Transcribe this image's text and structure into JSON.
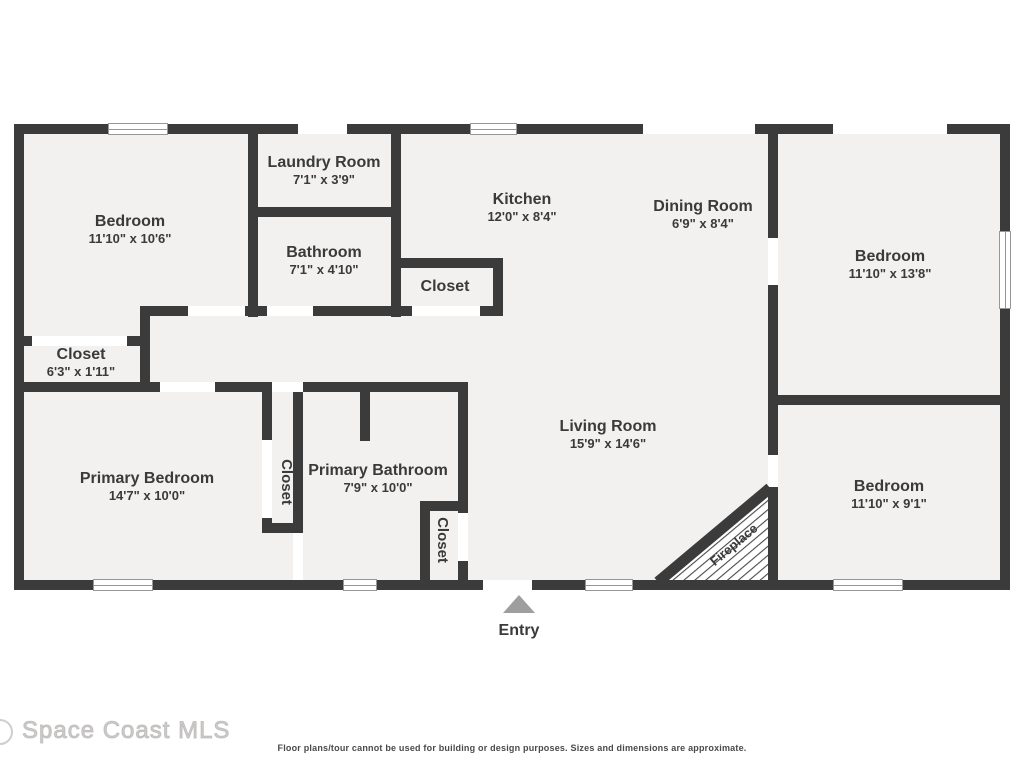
{
  "colors": {
    "wall": "#3b3b3b",
    "floor": "#f2f1f0",
    "window_line": "#979797",
    "entry_arrow": "#9e9e9e",
    "text": "#3a3a3a",
    "watermark": "#c1bfbd",
    "disclaimer": "#4a4a4a"
  },
  "watermark": "Space Coast MLS",
  "disclaimer": "Floor plans/tour cannot be used for building or design purposes. Sizes and dimensions are approximate.",
  "entry_label": "Entry",
  "rooms": [
    {
      "id": "bedroom-top-left",
      "name": "Bedroom",
      "dims": "11'10\" x 10'6\""
    },
    {
      "id": "laundry-room",
      "name": "Laundry Room",
      "dims": "7'1\" x 3'9\""
    },
    {
      "id": "bathroom",
      "name": "Bathroom",
      "dims": "7'1\" x 4'10\""
    },
    {
      "id": "kitchen",
      "name": "Kitchen",
      "dims": "12'0\" x 8'4\""
    },
    {
      "id": "dining-room",
      "name": "Dining Room",
      "dims": "6'9\" x 8'4\""
    },
    {
      "id": "bedroom-top-right",
      "name": "Bedroom",
      "dims": "11'10\" x 13'8\""
    },
    {
      "id": "closet-kitchen",
      "name": "Closet"
    },
    {
      "id": "closet-hall",
      "name": "Closet",
      "dims": "6'3\" x 1'11\""
    },
    {
      "id": "primary-bedroom",
      "name": "Primary Bedroom",
      "dims": "14'7\" x 10'0\""
    },
    {
      "id": "closet-primary",
      "name": "Closet"
    },
    {
      "id": "primary-bathroom",
      "name": "Primary Bathroom",
      "dims": "7'9\" x 10'0\""
    },
    {
      "id": "closet-entry",
      "name": "Closet"
    },
    {
      "id": "living-room",
      "name": "Living Room",
      "dims": "15'9\" x 14'6\""
    },
    {
      "id": "bedroom-bottom-right",
      "name": "Bedroom",
      "dims": "11'10\" x 9'1\""
    },
    {
      "id": "fireplace",
      "name": "Fireplace"
    }
  ]
}
